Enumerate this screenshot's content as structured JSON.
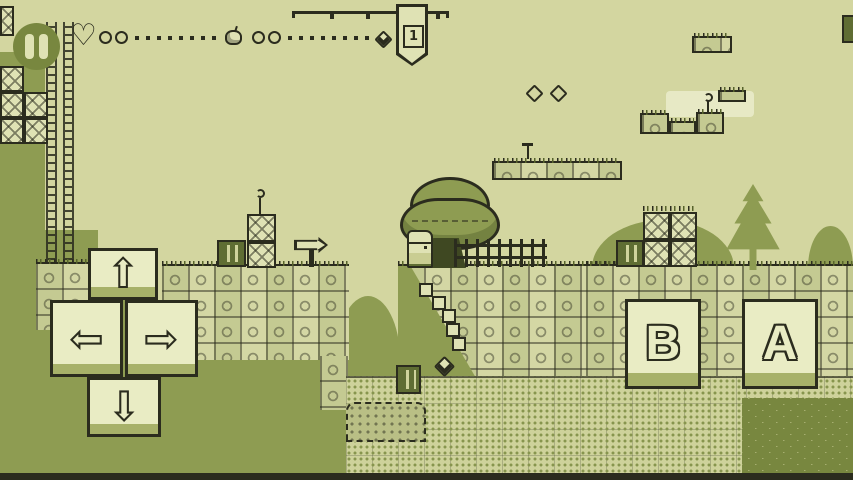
{
  "meta": {
    "app": "gameboy-style-platformer",
    "screen": "level-gameplay"
  },
  "palette": {
    "sky": "#d3d6a0",
    "tile_light": "#dfe2b4",
    "tile": "#d4d7a4",
    "mid_green": "#8e9c52",
    "dark_green": "#5f6d33",
    "outline": "#2b2c1e",
    "button_face": "#e9ecc4",
    "button_shade": "#a7b169",
    "pause_circle": "#78873f"
  },
  "hud": {
    "pause_button": {
      "icon": "pause-icon"
    },
    "hearts": {
      "icon": "heart-icon",
      "heart_glyph": "♡",
      "slots_filled": 2,
      "slots_empty": 8
    },
    "apples": {
      "icon": "apple-icon",
      "slots_filled": 2,
      "slots_empty": 8
    },
    "checkpoint": {
      "flag_number": "1",
      "gem_icon": "gem-icon"
    },
    "corner_item": {
      "icon": "crate-icon"
    }
  },
  "world": {
    "visible_diamond_outlines": 2,
    "entities": [
      "player-character",
      "big-tree",
      "pine-tree",
      "picket-fence",
      "arrow-sign",
      "wooden-crates",
      "cracked-brick-blocks",
      "vine-ladders",
      "stone-platforms",
      "floating-platforms",
      "gem",
      "sprout-plants",
      "grass-tufts",
      "hills",
      "dirt-ground"
    ]
  },
  "controls": {
    "dpad": {
      "up_glyph": "⇧",
      "left_glyph": "⇦",
      "right_glyph": "⇨",
      "down_glyph": "⇩"
    },
    "action_buttons": {
      "b_label": "B",
      "a_label": "A"
    }
  }
}
